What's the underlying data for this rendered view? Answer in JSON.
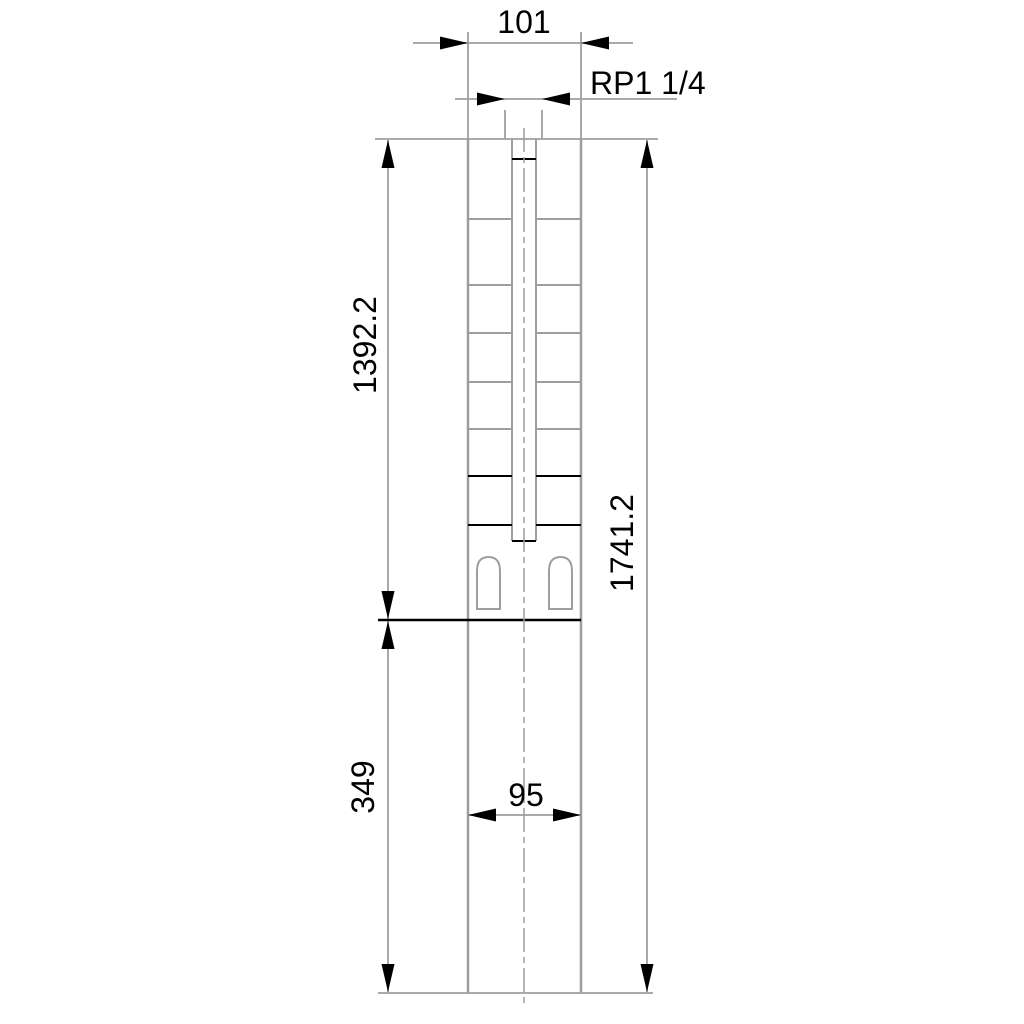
{
  "drawing": {
    "type": "technical-dimension-drawing",
    "subject": "submersible-pump-outline",
    "labels": {
      "top_width": "101",
      "thread_size": "RP1 1/4",
      "pump_section_length": "1392.2",
      "overall_length": "1741.2",
      "motor_section_length": "349",
      "lower_width": "95"
    },
    "colors": {
      "line_gray": "#9e9e9e",
      "feature_black": "#000000",
      "background": "#ffffff",
      "text": "#000000"
    }
  }
}
